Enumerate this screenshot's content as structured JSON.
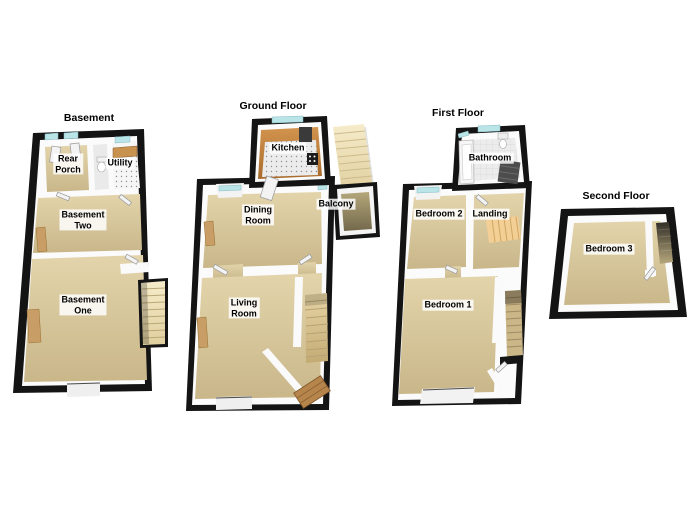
{
  "floors": [
    {
      "id": "basement",
      "title": "Basement",
      "rooms": [
        {
          "id": "rear-porch",
          "label": "Rear\nPorch"
        },
        {
          "id": "utility",
          "label": "Utility"
        },
        {
          "id": "basement-two",
          "label": "Basement\nTwo"
        },
        {
          "id": "basement-one",
          "label": "Basement\nOne"
        }
      ]
    },
    {
      "id": "ground-floor",
      "title": "Ground Floor",
      "rooms": [
        {
          "id": "kitchen",
          "label": "Kitchen"
        },
        {
          "id": "balcony",
          "label": "Balcony"
        },
        {
          "id": "dining-room",
          "label": "Dining\nRoom"
        },
        {
          "id": "living-room",
          "label": "Living\nRoom"
        }
      ]
    },
    {
      "id": "first-floor",
      "title": "First Floor",
      "rooms": [
        {
          "id": "bathroom",
          "label": "Bathroom"
        },
        {
          "id": "bedroom-2",
          "label": "Bedroom 2"
        },
        {
          "id": "landing",
          "label": "Landing"
        },
        {
          "id": "bedroom-1",
          "label": "Bedroom 1"
        }
      ]
    },
    {
      "id": "second-floor",
      "title": "Second Floor",
      "rooms": [
        {
          "id": "bedroom-3",
          "label": "Bedroom 3"
        }
      ]
    }
  ],
  "colors": {
    "wall": "#141414",
    "floor_beige": "#d9c79c",
    "kitchen_floor": "#c1803c",
    "balcony_floor": "#a3976c",
    "stairs_cream": "#f1e3ba",
    "stairs_tan": "#dcc795",
    "window_glass": "#b9e4e8",
    "wood_panel": "#c99d66",
    "label_text": "#000000",
    "background": "#ffffff"
  }
}
